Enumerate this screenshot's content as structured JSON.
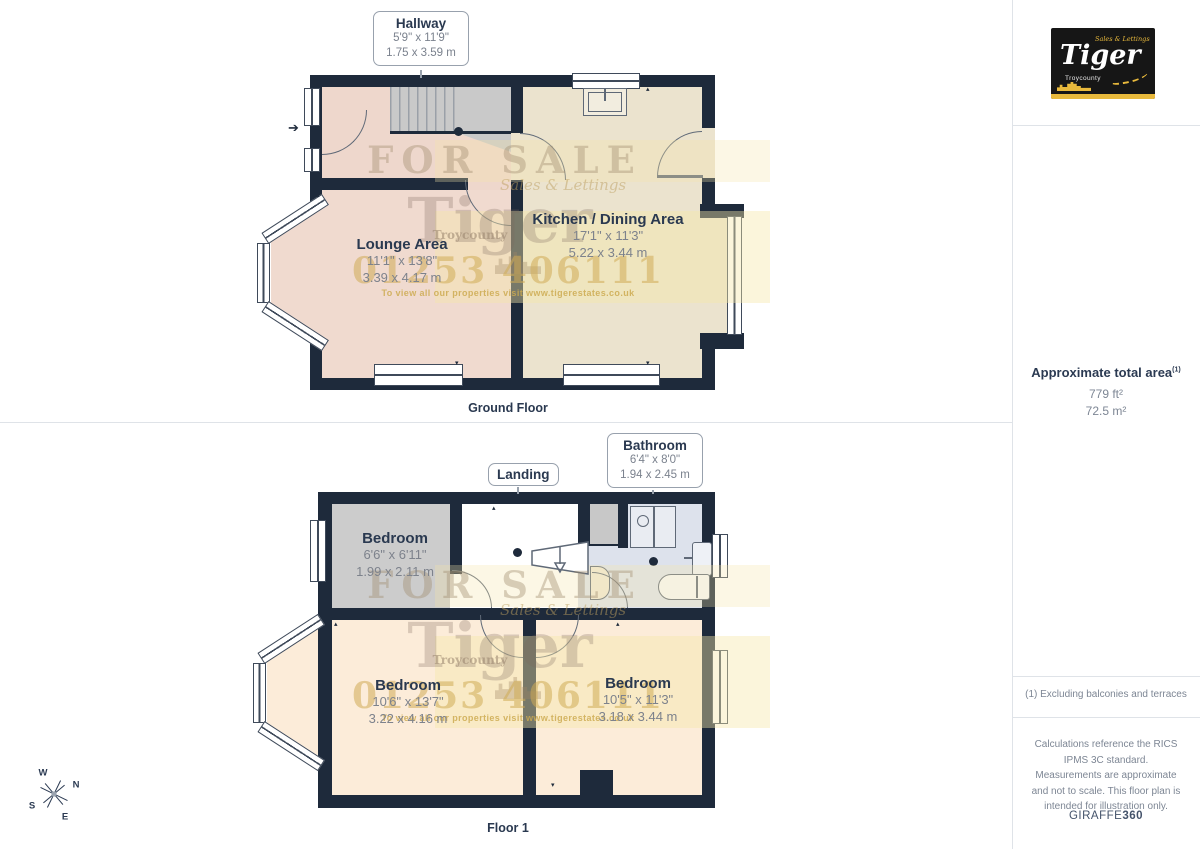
{
  "floors": [
    {
      "label": "Ground Floor",
      "rooms": [
        {
          "name": "Lounge Area",
          "imperial": "11'1\" x 13'8\"",
          "metric": "3.39 x 4.17 m"
        },
        {
          "name": "Kitchen / Dining Area",
          "imperial": "17'1\" x 11'3\"",
          "metric": "5.22 x 3.44 m"
        }
      ],
      "callouts": [
        {
          "name": "Hallway",
          "imperial": "5'9\" x 11'9\"",
          "metric": "1.75 x 3.59 m"
        }
      ]
    },
    {
      "label": "Floor 1",
      "rooms": [
        {
          "name": "Bedroom",
          "imperial": "6'6\" x 6'11\"",
          "metric": "1.99 x 2.11 m"
        },
        {
          "name": "Bedroom",
          "imperial": "10'6\" x 13'7\"",
          "metric": "3.22 x 4.16 m"
        },
        {
          "name": "Bedroom",
          "imperial": "10'5\" x 11'3\"",
          "metric": "3.18 x 3.44 m"
        }
      ],
      "callouts": [
        {
          "name": "Landing"
        },
        {
          "name": "Bathroom",
          "imperial": "6'4\" x 8'0\"",
          "metric": "1.94 x 2.45 m"
        }
      ]
    }
  ],
  "watermark": {
    "for_sale": "FOR SALE",
    "brand": "Tiger",
    "tagline": "Sales & Lettings",
    "subtitle": "Troycounty",
    "phone": "01253 406111",
    "url_line": "To view all our properties visit www.tigerestates.co.uk"
  },
  "compass": {
    "n": "N",
    "e": "E",
    "s": "S",
    "w": "W"
  },
  "sidebar": {
    "logo": {
      "brand": "Tiger",
      "tagline": "Sales & Lettings",
      "subtitle": "Troycounty"
    },
    "total_area": {
      "label": "Approximate total area",
      "footnote_ref": "(1)",
      "imperial": "779 ft²",
      "metric": "72.5 m²"
    },
    "footnote": "(1) Excluding balconies and terraces",
    "disclaimer": "Calculations reference the RICS IPMS 3C standard. Measurements are approximate and not to scale. This floor plan is intended for illustration only.",
    "credit": {
      "brand": "GIRAFFE",
      "suffix": "360"
    }
  },
  "colors": {
    "wall": "#1e2a3b",
    "hallway": "#eed7cc",
    "lounge": "#f0dacf",
    "kitchen": "#ebe3ce",
    "bedroom": "#fcecd9",
    "bedroom_small": "#cccccc",
    "bathroom": "#dde2ec",
    "stairs": "#c9c9c9",
    "accent_gold": "#e8b93c"
  }
}
